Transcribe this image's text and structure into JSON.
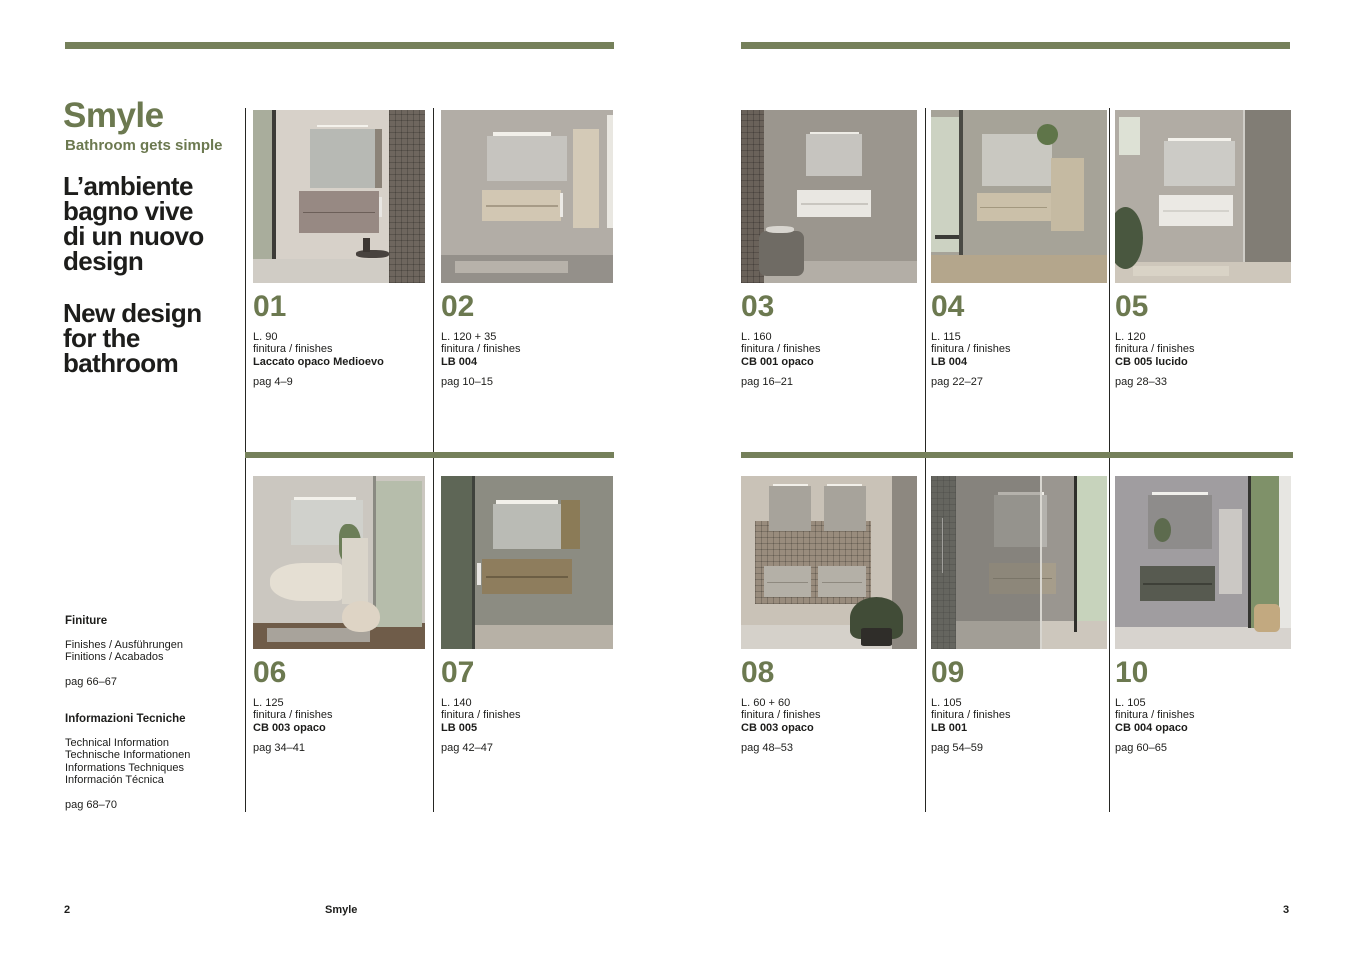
{
  "colors": {
    "accent_bar": "#75805a",
    "accent_text": "#6c7950",
    "body_text": "#1d1d1b",
    "divider": "#262623"
  },
  "left_page": {
    "brand_title": "Smyle",
    "brand_tagline": "Bathroom gets simple",
    "headline_it": [
      "L’ambiente",
      "bagno vive",
      "di un nuovo",
      "design"
    ],
    "headline_en": [
      "New design",
      "for the",
      "bathroom"
    ],
    "sections": [
      {
        "title": "Finiture",
        "lines": [
          "Finishes / Ausführungen",
          "Finitions / Acabados"
        ],
        "pages": "pag 66–67"
      },
      {
        "title": "Informazioni Tecniche",
        "lines": [
          "Technical Information",
          "Technische Informationen",
          "Informations Techniques",
          "Información Técnica"
        ],
        "pages": "pag 68–70"
      }
    ],
    "footer_page_number": "2",
    "footer_label": "Smyle"
  },
  "right_page": {
    "footer_page_number": "3"
  },
  "catalog": {
    "left_top": [
      {
        "number": "01",
        "length": "L. 90",
        "finish_label": "finitura / finishes",
        "finish": "Laccato opaco Medioevo",
        "pages": "pag 4–9",
        "scene": [
          {
            "x": 0,
            "y": 0,
            "w": 100,
            "h": 100,
            "c": "#d7d1c9"
          },
          {
            "x": 0,
            "y": 86,
            "w": 100,
            "h": 14,
            "c": "#d0ccc5"
          },
          {
            "x": 0,
            "y": 0,
            "w": 12,
            "h": 86,
            "c": "#a9ad9c"
          },
          {
            "x": 11,
            "y": 0,
            "w": 2.5,
            "h": 86,
            "c": "#3c3b37"
          },
          {
            "x": 79,
            "y": 0,
            "w": 21,
            "h": 100,
            "c": "#6e665e",
            "t": "tile"
          },
          {
            "x": 37,
            "y": 8.5,
            "w": 30,
            "h": 1.6,
            "c": "#f4f2ec"
          },
          {
            "x": 33,
            "y": 11,
            "w": 42,
            "h": 34,
            "c": "#b7b9b4"
          },
          {
            "x": 71,
            "y": 11,
            "w": 4,
            "h": 34,
            "c": "#8b8378"
          },
          {
            "x": 27,
            "y": 47,
            "w": 46,
            "h": 24,
            "c": "#978983"
          },
          {
            "x": 29,
            "y": 59,
            "w": 42,
            "h": 0.8,
            "c": "#6c5f59"
          },
          {
            "x": 73.5,
            "y": 50,
            "w": 1.4,
            "h": 12,
            "c": "#e8e6e2"
          },
          {
            "x": 60,
            "y": 81,
            "w": 19,
            "h": 4.5,
            "c": "#48423e",
            "r": "40%"
          },
          {
            "x": 64,
            "y": 74,
            "w": 4,
            "h": 8,
            "c": "#3c3632"
          }
        ]
      },
      {
        "number": "02",
        "length": "L. 120 + 35",
        "finish_label": "finitura / finishes",
        "finish": "LB 004",
        "pages": "pag 10–15",
        "scene": [
          {
            "x": 0,
            "y": 0,
            "w": 100,
            "h": 100,
            "c": "#b2ada6"
          },
          {
            "x": 0,
            "y": 84,
            "w": 100,
            "h": 16,
            "c": "#94908a"
          },
          {
            "x": 8,
            "y": 87,
            "w": 66,
            "h": 7,
            "c": "#b7b2aa"
          },
          {
            "x": 30,
            "y": 13,
            "w": 34,
            "h": 2,
            "c": "#f2f0ea"
          },
          {
            "x": 27,
            "y": 15,
            "w": 46,
            "h": 26,
            "c": "#c6c4bf"
          },
          {
            "x": 24,
            "y": 46,
            "w": 46,
            "h": 18,
            "c": "#d2c7b3"
          },
          {
            "x": 26,
            "y": 55,
            "w": 42,
            "h": 0.8,
            "c": "#a79b87"
          },
          {
            "x": 69,
            "y": 48,
            "w": 2,
            "h": 14,
            "c": "#eceae6"
          },
          {
            "x": 77,
            "y": 11,
            "w": 15,
            "h": 57,
            "c": "#d4cab7"
          },
          {
            "x": 96.5,
            "y": 3,
            "w": 3.5,
            "h": 65,
            "c": "#e9e7e1"
          }
        ]
      }
    ],
    "left_bottom": [
      {
        "number": "06",
        "length": "L. 125",
        "finish_label": "finitura / finishes",
        "finish": "CB 003 opaco",
        "pages": "pag 34–41",
        "scene": [
          {
            "x": 0,
            "y": 0,
            "w": 100,
            "h": 100,
            "c": "#cbc7c0"
          },
          {
            "x": 0,
            "y": 85,
            "w": 100,
            "h": 15,
            "c": "#6f5c49"
          },
          {
            "x": 8,
            "y": 88,
            "w": 60,
            "h": 8,
            "c": "#a8a39b"
          },
          {
            "x": 71,
            "y": 3,
            "w": 27,
            "h": 84,
            "c": "#b6bdab"
          },
          {
            "x": 70,
            "y": 0,
            "w": 1.5,
            "h": 88,
            "c": "#8a8a82"
          },
          {
            "x": 24,
            "y": 12,
            "w": 36,
            "h": 1.8,
            "c": "#f3f1eb"
          },
          {
            "x": 22,
            "y": 14,
            "w": 42,
            "h": 26,
            "c": "#d0d1cc"
          },
          {
            "x": 50,
            "y": 28,
            "w": 13,
            "h": 22,
            "c": "#6c7e58",
            "r": "40% 60% 60% 40%"
          },
          {
            "x": 52,
            "y": 36,
            "w": 15,
            "h": 38,
            "c": "#dad5ca"
          },
          {
            "x": 10,
            "y": 50,
            "w": 42,
            "h": 22,
            "c": "#e5dfd3",
            "r": "45% 8% 8% 45%"
          },
          {
            "x": 52,
            "y": 72,
            "w": 22,
            "h": 18,
            "c": "#ded4c5",
            "r": "50% 50% 45% 45%"
          }
        ]
      },
      {
        "number": "07",
        "length": "L. 140",
        "finish_label": "finitura / finishes",
        "finish": "LB 005",
        "pages": "pag 42–47",
        "scene": [
          {
            "x": 0,
            "y": 0,
            "w": 100,
            "h": 100,
            "c": "#8c8c82"
          },
          {
            "x": 0,
            "y": 86,
            "w": 100,
            "h": 14,
            "c": "#b7b1a6"
          },
          {
            "x": 0,
            "y": 0,
            "w": 19,
            "h": 100,
            "c": "#5e6656"
          },
          {
            "x": 18,
            "y": 0,
            "w": 2,
            "h": 100,
            "c": "#3f423c"
          },
          {
            "x": 32,
            "y": 14,
            "w": 36,
            "h": 2,
            "c": "#f2f0ea"
          },
          {
            "x": 30,
            "y": 16,
            "w": 40,
            "h": 26,
            "c": "#babbb5"
          },
          {
            "x": 70,
            "y": 14,
            "w": 11,
            "h": 28,
            "c": "#8b7b57"
          },
          {
            "x": 24,
            "y": 48,
            "w": 52,
            "h": 20,
            "c": "#8e7d5d"
          },
          {
            "x": 26,
            "y": 58,
            "w": 48,
            "h": 0.8,
            "c": "#6c5e44"
          },
          {
            "x": 21,
            "y": 50,
            "w": 2,
            "h": 13,
            "c": "#e9e7e3"
          }
        ]
      }
    ],
    "right_top": [
      {
        "number": "03",
        "length": "L. 160",
        "finish_label": "finitura / finishes",
        "finish": "CB 001 opaco",
        "pages": "pag 16–21",
        "scene": [
          {
            "x": 0,
            "y": 0,
            "w": 100,
            "h": 100,
            "c": "#9b968e"
          },
          {
            "x": 0,
            "y": 87,
            "w": 100,
            "h": 13,
            "c": "#b3aea6"
          },
          {
            "x": 0,
            "y": 0,
            "w": 13,
            "h": 100,
            "c": "#6a625a",
            "t": "tile"
          },
          {
            "x": 39,
            "y": 12.5,
            "w": 28,
            "h": 1.8,
            "c": "#eeece6"
          },
          {
            "x": 37,
            "y": 14,
            "w": 32,
            "h": 24,
            "c": "#c6c4bf"
          },
          {
            "x": 32,
            "y": 46,
            "w": 42,
            "h": 16,
            "c": "#e9e7e2"
          },
          {
            "x": 34,
            "y": 54,
            "w": 38,
            "h": 0.7,
            "c": "#c9c6c0"
          },
          {
            "x": 10,
            "y": 70,
            "w": 26,
            "h": 26,
            "c": "#6f6b64",
            "r": "16%"
          },
          {
            "x": 14,
            "y": 67,
            "w": 16,
            "h": 4,
            "c": "#d8d5cf",
            "r": "40%"
          }
        ]
      },
      {
        "number": "04",
        "length": "L. 115",
        "finish_label": "finitura / finishes",
        "finish": "LB 004",
        "pages": "pag 22–27",
        "scene": [
          {
            "x": 0,
            "y": 0,
            "w": 100,
            "h": 100,
            "c": "#a6a398"
          },
          {
            "x": 0,
            "y": 84,
            "w": 100,
            "h": 16,
            "c": "#b4a68c"
          },
          {
            "x": 0,
            "y": 4,
            "w": 17,
            "h": 78,
            "c": "#ccd2c2"
          },
          {
            "x": 16,
            "y": 0,
            "w": 2,
            "h": 84,
            "c": "#4a4a44"
          },
          {
            "x": 29,
            "y": 14,
            "w": 40,
            "h": 30,
            "c": "#c9c8c1"
          },
          {
            "x": 60,
            "y": 8,
            "w": 12,
            "h": 12,
            "c": "#5f7549",
            "r": "50%"
          },
          {
            "x": 26,
            "y": 48,
            "w": 42,
            "h": 16,
            "c": "#cbc0a9"
          },
          {
            "x": 28,
            "y": 56,
            "w": 38,
            "h": 0.8,
            "c": "#a3987f"
          },
          {
            "x": 68,
            "y": 28,
            "w": 19,
            "h": 42,
            "c": "#c5baa2"
          },
          {
            "x": 2,
            "y": 72,
            "w": 14,
            "h": 2.5,
            "c": "#3b3b37"
          }
        ]
      },
      {
        "number": "05",
        "length": "L. 120",
        "finish_label": "finitura / finishes",
        "finish": "CB 005 lucido",
        "pages": "pag 28–33",
        "scene": [
          {
            "x": 0,
            "y": 0,
            "w": 100,
            "h": 100,
            "c": "#b1aca4"
          },
          {
            "x": 0,
            "y": 88,
            "w": 100,
            "h": 12,
            "c": "#cec7bb"
          },
          {
            "x": 10,
            "y": 90,
            "w": 55,
            "h": 6,
            "c": "#d9d3c6"
          },
          {
            "x": 2,
            "y": 4,
            "w": 12,
            "h": 22,
            "c": "#dde1d5"
          },
          {
            "x": 30,
            "y": 16,
            "w": 36,
            "h": 1.8,
            "c": "#f3f1eb"
          },
          {
            "x": 28,
            "y": 18,
            "w": 40,
            "h": 26,
            "c": "#cccbc6"
          },
          {
            "x": 25,
            "y": 49,
            "w": 42,
            "h": 18,
            "c": "#ebe9e4"
          },
          {
            "x": 27,
            "y": 58,
            "w": 38,
            "h": 0.7,
            "c": "#d4d2cc"
          },
          {
            "x": 73,
            "y": 0,
            "w": 27,
            "h": 88,
            "c": "#7a766e",
            "o": 0.88
          },
          {
            "x": 73,
            "y": 0,
            "w": 1,
            "h": 88,
            "c": "#cfcdc7"
          },
          {
            "x": -4,
            "y": 56,
            "w": 20,
            "h": 36,
            "c": "#49573f",
            "r": "50%"
          }
        ]
      }
    ],
    "right_bottom": [
      {
        "number": "08",
        "length": "L. 60 + 60",
        "finish_label": "finitura / finishes",
        "finish": "CB 003 opaco",
        "pages": "pag 48–53",
        "scene": [
          {
            "x": 0,
            "y": 0,
            "w": 100,
            "h": 100,
            "c": "#c9c2b7"
          },
          {
            "x": 0,
            "y": 86,
            "w": 86,
            "h": 14,
            "c": "#d5d1ca"
          },
          {
            "x": 8,
            "y": 26,
            "w": 66,
            "h": 48,
            "c": "#998c7d",
            "t": "tile"
          },
          {
            "x": 18,
            "y": 4.5,
            "w": 20,
            "h": 1.6,
            "c": "#f2f0ea"
          },
          {
            "x": 49,
            "y": 4.5,
            "w": 20,
            "h": 1.6,
            "c": "#f2f0ea"
          },
          {
            "x": 16,
            "y": 6,
            "w": 24,
            "h": 26,
            "c": "#a7a39b"
          },
          {
            "x": 47,
            "y": 6,
            "w": 24,
            "h": 26,
            "c": "#a7a39b"
          },
          {
            "x": 13,
            "y": 52,
            "w": 27,
            "h": 18,
            "c": "#b4b0a7"
          },
          {
            "x": 44,
            "y": 52,
            "w": 27,
            "h": 18,
            "c": "#b4b0a7"
          },
          {
            "x": 15,
            "y": 61,
            "w": 23,
            "h": 0.7,
            "c": "#8e897f"
          },
          {
            "x": 46,
            "y": 61,
            "w": 23,
            "h": 0.7,
            "c": "#8e897f"
          },
          {
            "x": 86,
            "y": 0,
            "w": 14,
            "h": 100,
            "c": "#8d8880"
          },
          {
            "x": 62,
            "y": 70,
            "w": 30,
            "h": 24,
            "c": "#414c37",
            "r": "50% 50% 20% 20%"
          },
          {
            "x": 68,
            "y": 88,
            "w": 18,
            "h": 10,
            "c": "#2f2d29",
            "r": "10%"
          }
        ]
      },
      {
        "number": "09",
        "length": "L. 105",
        "finish_label": "finitura / finishes",
        "finish": "LB 001",
        "pages": "pag 54–59",
        "scene": [
          {
            "x": 0,
            "y": 0,
            "w": 100,
            "h": 100,
            "c": "#9a9690"
          },
          {
            "x": 0,
            "y": 84,
            "w": 100,
            "h": 16,
            "c": "#cdc7bd"
          },
          {
            "x": 83,
            "y": 0,
            "w": 17,
            "h": 84,
            "c": "#c7d3bc"
          },
          {
            "x": 81,
            "y": 0,
            "w": 2,
            "h": 90,
            "c": "#2f2f2b"
          },
          {
            "x": 38,
            "y": 9,
            "w": 26,
            "h": 1.8,
            "c": "#eeece6"
          },
          {
            "x": 36,
            "y": 11,
            "w": 30,
            "h": 30,
            "c": "#b4b2ad"
          },
          {
            "x": 33,
            "y": 50,
            "w": 38,
            "h": 18,
            "c": "#a69d8b"
          },
          {
            "x": 35,
            "y": 59,
            "w": 34,
            "h": 0.8,
            "c": "#847c6b"
          },
          {
            "x": 0,
            "y": 0,
            "w": 14,
            "h": 100,
            "c": "#5d5f59",
            "t": "tile"
          },
          {
            "x": 6,
            "y": 24,
            "w": 1,
            "h": 32,
            "c": "#c9c9c6"
          },
          {
            "x": 0,
            "y": 0,
            "w": 63,
            "h": 100,
            "c": "#6f6d66",
            "o": 0.45
          },
          {
            "x": 62,
            "y": 0,
            "w": 1,
            "h": 100,
            "c": "#d8d6d0"
          }
        ]
      },
      {
        "number": "10",
        "length": "L. 105",
        "finish_label": "finitura / finishes",
        "finish": "CB 004 opaco",
        "pages": "pag 60–65",
        "scene": [
          {
            "x": 0,
            "y": 0,
            "w": 100,
            "h": 100,
            "c": "#a09da0"
          },
          {
            "x": 0,
            "y": 87,
            "w": 100,
            "h": 13,
            "c": "#d7d3ce"
          },
          {
            "x": 21,
            "y": 9.5,
            "w": 32,
            "h": 1.8,
            "c": "#f1f0ec"
          },
          {
            "x": 19,
            "y": 11,
            "w": 36,
            "h": 31,
            "c": "#8e8c8b"
          },
          {
            "x": 22,
            "y": 24,
            "w": 10,
            "h": 14,
            "c": "#5d6b4e",
            "r": "50%"
          },
          {
            "x": 59,
            "y": 19,
            "w": 13,
            "h": 49,
            "c": "#cbc8c4"
          },
          {
            "x": 77,
            "y": 0,
            "w": 23,
            "h": 88,
            "c": "#7f9169"
          },
          {
            "x": 93,
            "y": 0,
            "w": 7,
            "h": 88,
            "c": "#e7e6e2"
          },
          {
            "x": 75.5,
            "y": 0,
            "w": 2,
            "h": 88,
            "c": "#343430"
          },
          {
            "x": 14,
            "y": 52,
            "w": 43,
            "h": 20,
            "c": "#575a50"
          },
          {
            "x": 16,
            "y": 62,
            "w": 39,
            "h": 0.8,
            "c": "#3e4038"
          },
          {
            "x": 79,
            "y": 74,
            "w": 15,
            "h": 16,
            "c": "#c2a980",
            "r": "20%"
          }
        ]
      }
    ]
  }
}
